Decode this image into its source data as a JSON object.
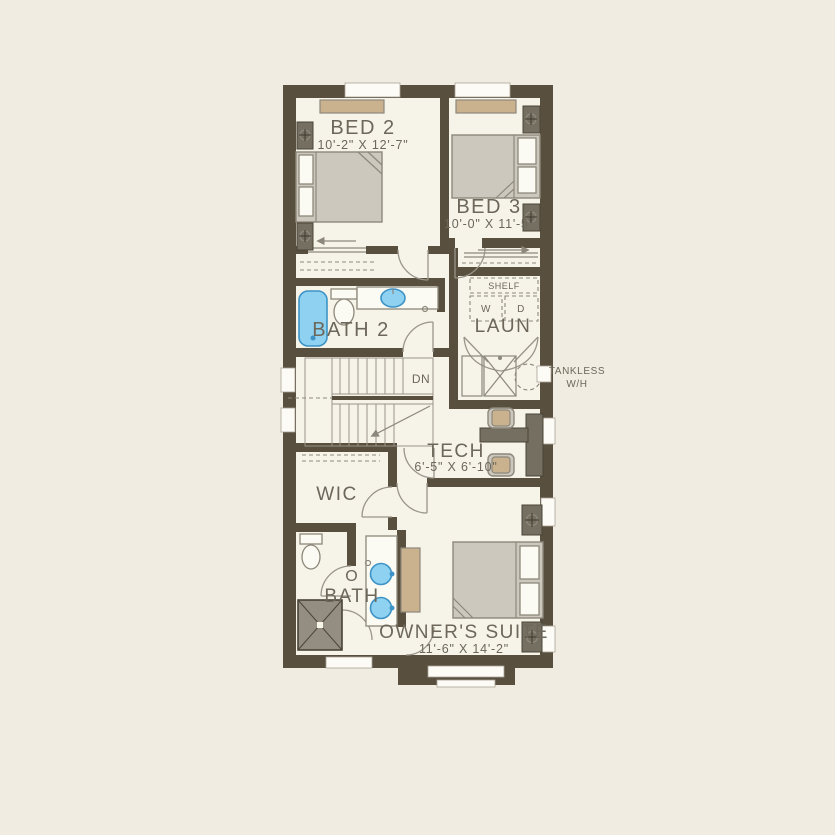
{
  "plan": {
    "type": "residential-second-floor-plan",
    "rooms": {
      "bed2": {
        "label": "BED 2",
        "dims": "10'-2\" X 12'-7\""
      },
      "bed3": {
        "label": "BED 3",
        "dims": "10'-0\" X 11'-5\""
      },
      "bath2": {
        "label": "BATH 2"
      },
      "laundry": {
        "label": "LAUN",
        "shelf": "SHELF",
        "washer": "W",
        "dryer": "D"
      },
      "tech": {
        "label": "TECH",
        "dims": "6'-5\" X 6'-10\""
      },
      "wic": {
        "label": "WIC"
      },
      "owners_bath": {
        "label_line1": "O",
        "label_line2": "BATH"
      },
      "owners_suite": {
        "label": "OWNER'S SUITE",
        "dims": "11'-6\" X 14'-2\""
      }
    },
    "annotations": {
      "stairs_down": "DN",
      "tankless_line1": "TANKLESS",
      "tankless_line2": "W/H"
    },
    "colors": {
      "background": "#f0ece1",
      "floor": "#f6f3e9",
      "wall": "#584f3e",
      "furniture_tan": "#cbb28f",
      "furniture_gray": "#ccc8bd",
      "furniture_dark": "#756f61",
      "fixture_blue": "#8ed1f0",
      "line": "#8d887b",
      "text": "#6d675a"
    }
  }
}
